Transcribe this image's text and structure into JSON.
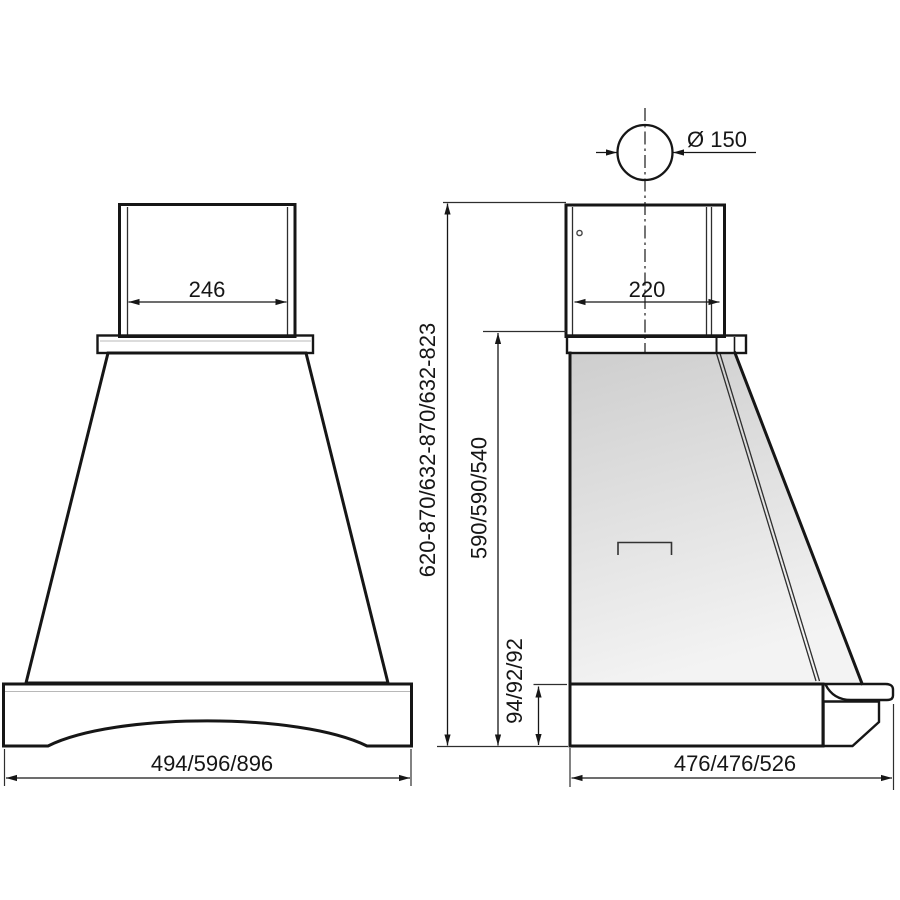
{
  "diagram": {
    "front_view": {
      "chimney_width": "246",
      "width_options": "494/596/896"
    },
    "side_view": {
      "duct_diameter": "Ø 150",
      "chimney_depth": "220",
      "total_height_options": "620-870/632-870/632-823",
      "canopy_height_options": "590/590/540",
      "base_height_options": "94/92/92",
      "depth_options": "476/476/526"
    },
    "colors": {
      "wood": "#f1e1bf",
      "line": "#161616",
      "background": "#ffffff"
    }
  }
}
